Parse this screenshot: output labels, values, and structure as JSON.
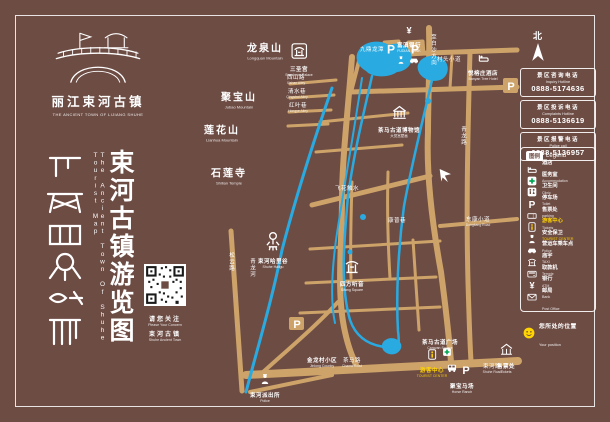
{
  "colors": {
    "background": "#6D4C44",
    "road": "#CDA369",
    "river": "#29ABE2",
    "highlight": "#FFD400",
    "clinic_green": "#00A651"
  },
  "poster": {
    "logo": {
      "cn": "丽江束河古镇",
      "en": "THE ANCIENT TOWN OF LIJIANG SHUHE"
    },
    "title": {
      "cn": "束河古镇游览图",
      "en": "The Ancient Town Of Shuhe Tourist Map"
    },
    "qr": {
      "cn1": "请您关注",
      "en1": "Please Your Concern",
      "cn2": "束河古镇",
      "en2": "Shuhe Ancient Town"
    },
    "compass": "北"
  },
  "hotlines": [
    {
      "cn": "景区咨询电话",
      "en": "Inquiry Hotline",
      "tel": "0888-5174636"
    },
    {
      "cn": "景区投诉电话",
      "en": "Complaints Hotline",
      "tel": "0888-5136619"
    },
    {
      "cn": "景区报警电话",
      "en": "Police call",
      "tel": "0888-5136957"
    }
  ],
  "legend": {
    "title_cn": "图例",
    "title_en": "Legend",
    "items": [
      {
        "icon": "bed",
        "cn": "酒店",
        "en": "Accommodation"
      },
      {
        "icon": "cross",
        "cn": "医务室",
        "en": "Clinic"
      },
      {
        "icon": "toilet",
        "cn": "卫生间",
        "en": "Toilet"
      },
      {
        "icon": "parking",
        "cn": "停车场",
        "en": "parking"
      },
      {
        "icon": "ticket",
        "cn": "售票处",
        "en": "Tickets"
      },
      {
        "icon": "info",
        "cn": "游客中心",
        "en": "TOURIST CENTER",
        "highlight": true
      },
      {
        "icon": "police",
        "cn": "安全保卫",
        "en": "Police"
      },
      {
        "icon": "car",
        "cn": "营运车乘车点",
        "en": "TAXI"
      },
      {
        "icon": "temple",
        "cn": "庙宇",
        "en": "Temple"
      },
      {
        "icon": "atm",
        "cn": "取款机",
        "en": "ATM"
      },
      {
        "icon": "yuan",
        "cn": "银行",
        "en": "Bank"
      },
      {
        "icon": "mail",
        "cn": "邮局",
        "en": "Post Office"
      }
    ]
  },
  "position": {
    "cn": "您所处的位置",
    "en": "Your position"
  },
  "map": {
    "mountains": [
      {
        "cn": "龙泉山",
        "en": "Longquan Mountain",
        "x": 265,
        "y": 50
      },
      {
        "cn": "聚宝山",
        "en": "Jubao Mountain",
        "x": 239,
        "y": 99
      },
      {
        "cn": "莲花山",
        "en": "Lianhua Mountain",
        "x": 222,
        "y": 132
      },
      {
        "cn": "石莲寺",
        "en": "Shilian Temple",
        "x": 229,
        "y": 175
      }
    ],
    "pois": [
      {
        "icon": "temple-box",
        "size": 16,
        "cn": "三圣宫",
        "en": "Sansheng Palace",
        "x": 299,
        "y": 51
      },
      {
        "icon": "museum",
        "size": 15,
        "cn": "茶马古道博物馆",
        "en": "大觉宫壁画",
        "x": 399,
        "y": 112
      },
      {
        "icon": "yuan",
        "size": 10,
        "cn": "富滇银行",
        "en": "FUDIAN BANK",
        "x": 409,
        "y": 27
      },
      {
        "icon": "bed",
        "size": 11,
        "cn": "悦榕庄酒店",
        "en": "Banyan Tree Hotel",
        "x": 483,
        "y": 55
      },
      {
        "icon": "sifang",
        "size": 16,
        "cn": "四方听音",
        "en": "Sifang Square",
        "x": 352,
        "y": 266
      },
      {
        "icon": "ornament",
        "size": 20,
        "cn": "束河哈里谷",
        "en": "Shuhe Haligu",
        "x": 273,
        "y": 241
      },
      {
        "icon": "police",
        "size": 12,
        "cn": "束河派出所",
        "en": "Police",
        "x": 265,
        "y": 378
      },
      {
        "icon": "info",
        "size": 11,
        "cn": "游客中心",
        "en": "TOURIST CENTER",
        "x": 432,
        "y": 352,
        "highlight": true
      },
      {
        "icon": "none",
        "size": 0,
        "cn": "茶马古道广场",
        "en": "Caravan Square",
        "x": 440,
        "y": 337
      },
      {
        "icon": "none",
        "size": 0,
        "cn": "聚宝马场",
        "en": "Horse Ranch",
        "x": 462,
        "y": 381
      },
      {
        "icon": "gate",
        "size": 13,
        "cn": "售票处",
        "en": "Tickets",
        "x": 506,
        "y": 349
      },
      {
        "icon": "none",
        "size": 0,
        "cn": "金龙村小区",
        "en": "Jinlong Country",
        "x": 322,
        "y": 355
      }
    ],
    "markers": [
      {
        "icon": "parking",
        "size": 12,
        "x": 391,
        "y": 49
      },
      {
        "icon": "parking",
        "size": 12,
        "x": 415,
        "y": 49
      },
      {
        "icon": "parking",
        "size": 11,
        "x": 511,
        "y": 86
      },
      {
        "icon": "parking",
        "size": 11,
        "x": 297,
        "y": 324
      },
      {
        "icon": "parking",
        "size": 11,
        "x": 466,
        "y": 370
      },
      {
        "icon": "bus",
        "size": 11,
        "x": 452,
        "y": 368
      },
      {
        "icon": "police",
        "size": 9,
        "x": 401,
        "y": 60
      },
      {
        "icon": "car",
        "size": 10,
        "x": 414,
        "y": 60
      },
      {
        "icon": "cross",
        "size": 9,
        "x": 447,
        "y": 352
      },
      {
        "icon": "landmark",
        "size": 16,
        "x": 445,
        "y": 175
      }
    ],
    "roads": [
      {
        "cn": "松云路",
        "x": 231,
        "y": 262,
        "vertical": true
      },
      {
        "cn": "青龙河",
        "x": 252,
        "y": 268,
        "vertical": true
      },
      {
        "cn": "至白沙方向",
        "x": 433,
        "y": 50,
        "vertical": true
      },
      {
        "cn": "青龙路",
        "x": 463,
        "y": 136,
        "vertical": true
      },
      {
        "cn": "茶马路",
        "en": "Chama Road",
        "x": 352,
        "y": 362
      },
      {
        "cn": "束河路",
        "en": "Shuhe Road",
        "x": 492,
        "y": 368
      },
      {
        "cn": "东康小道",
        "en": "Dongkang Road",
        "x": 478,
        "y": 221
      },
      {
        "cn": "村头小道",
        "x": 449,
        "y": 59
      },
      {
        "cn": "飞花触水",
        "x": 347,
        "y": 188
      },
      {
        "cn": "康普巷",
        "x": 397,
        "y": 220
      },
      {
        "cn": "西山路",
        "en": "Xishan Alley",
        "x": 296,
        "y": 79
      },
      {
        "cn": "清水巷",
        "en": "Qingshui Alley",
        "x": 297,
        "y": 93
      },
      {
        "cn": "红叶巷",
        "en": "Hongye Alley",
        "x": 298,
        "y": 107
      },
      {
        "cn": "九鼎龙潭",
        "x": 372,
        "y": 49
      }
    ]
  }
}
